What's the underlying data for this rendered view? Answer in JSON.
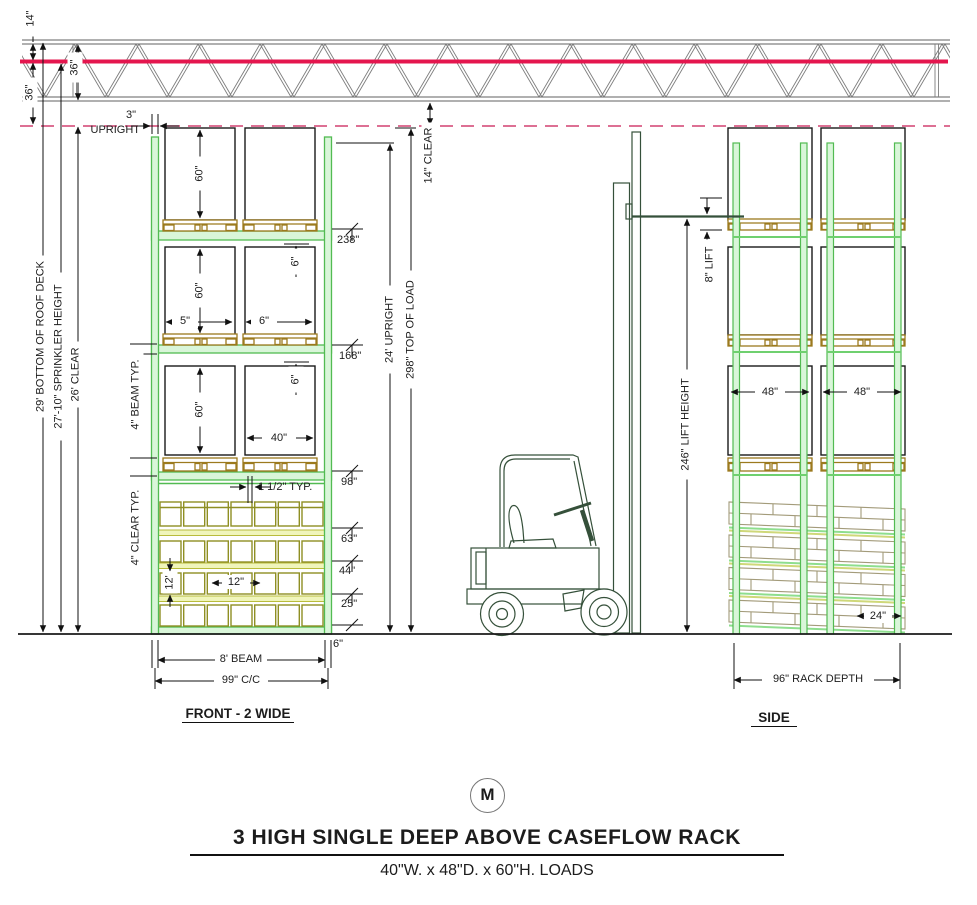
{
  "drawing": {
    "roof": {
      "deck_offset": "14\"",
      "sprinkler_drop": "36\"",
      "joist_depth": "36\""
    },
    "left_dims": {
      "roof_deck": "29' BOTTOM OF ROOF DECK",
      "sprinkler": "27'-10\" SPRINKLER HEIGHT",
      "clear": "26' CLEAR"
    },
    "front": {
      "upright_width": "3\"",
      "upright_word": "UPRIGHT",
      "load_height_1": "60\"",
      "load_height_2": "60\"",
      "load_height_3": "60\"",
      "side_clearance": "5\"",
      "load_gap": "6\"",
      "load_width": "40\"",
      "beam_clearance_2": "6\"",
      "beam_clearance_3": "6\"",
      "level_238": "238\"",
      "level_168": "168\"",
      "level_98": "98\"",
      "level_63": "63\"",
      "level_44": "44\"",
      "level_25": "25\"",
      "level_6": "6\"",
      "lane_gap": "1 1/2\" TYP.",
      "beam_typ": "4\" BEAM TYP.",
      "clear_typ": "4\" CLEAR TYP.",
      "case_height": "12'",
      "case_width": "12\"",
      "beam_length": "8' BEAM",
      "cc": "99\" C/C",
      "caption": "FRONT - 2 WIDE"
    },
    "vertical": {
      "upright": "24' UPRIGHT",
      "top_of_load": "298\" TOP OF LOAD",
      "clear": "14\" CLEAR"
    },
    "lift": {
      "lift": "8\" LIFT",
      "lift_height": "246\" LIFT HEIGHT"
    },
    "side": {
      "depth_1": "48\"",
      "depth_2": "48\"",
      "case_depth": "24\"",
      "rack_depth": "96\" RACK DEPTH",
      "caption": "SIDE"
    },
    "footer": {
      "logo": "M",
      "title": "3 HIGH SINGLE DEEP ABOVE CASEFLOW RACK",
      "subtitle": "40\"W. x 48\"D. x 60\"H. LOADS"
    }
  }
}
